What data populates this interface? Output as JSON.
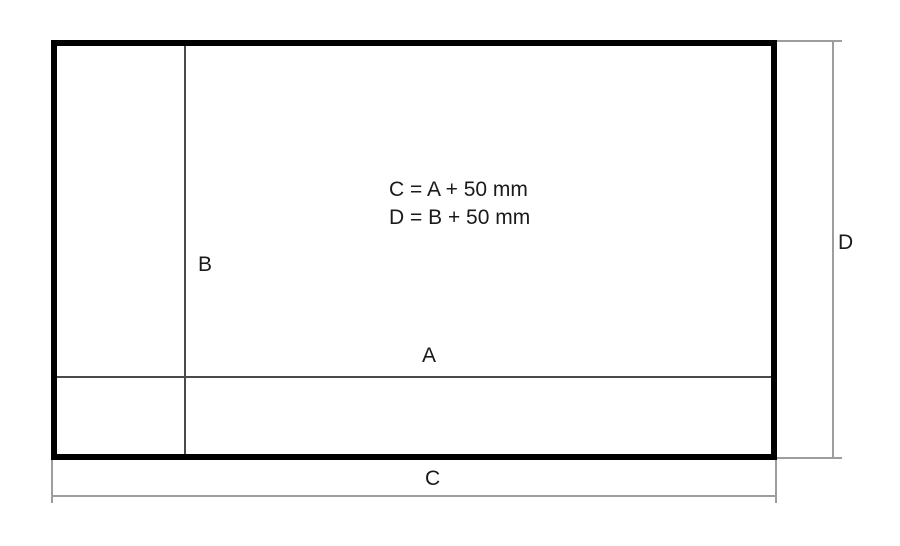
{
  "diagram": {
    "formula_lines": [
      "C = A + 50 mm",
      "D = B + 50 mm"
    ],
    "labels": {
      "inner_width": "A",
      "inner_height": "B",
      "outer_width": "C",
      "outer_height": "D"
    },
    "colors": {
      "background": "#ffffff",
      "outer_border": "#000000",
      "inner_line": "#4a4a4a",
      "dimension_line": "#9d9d9d",
      "text": "#1a1a1a"
    }
  }
}
